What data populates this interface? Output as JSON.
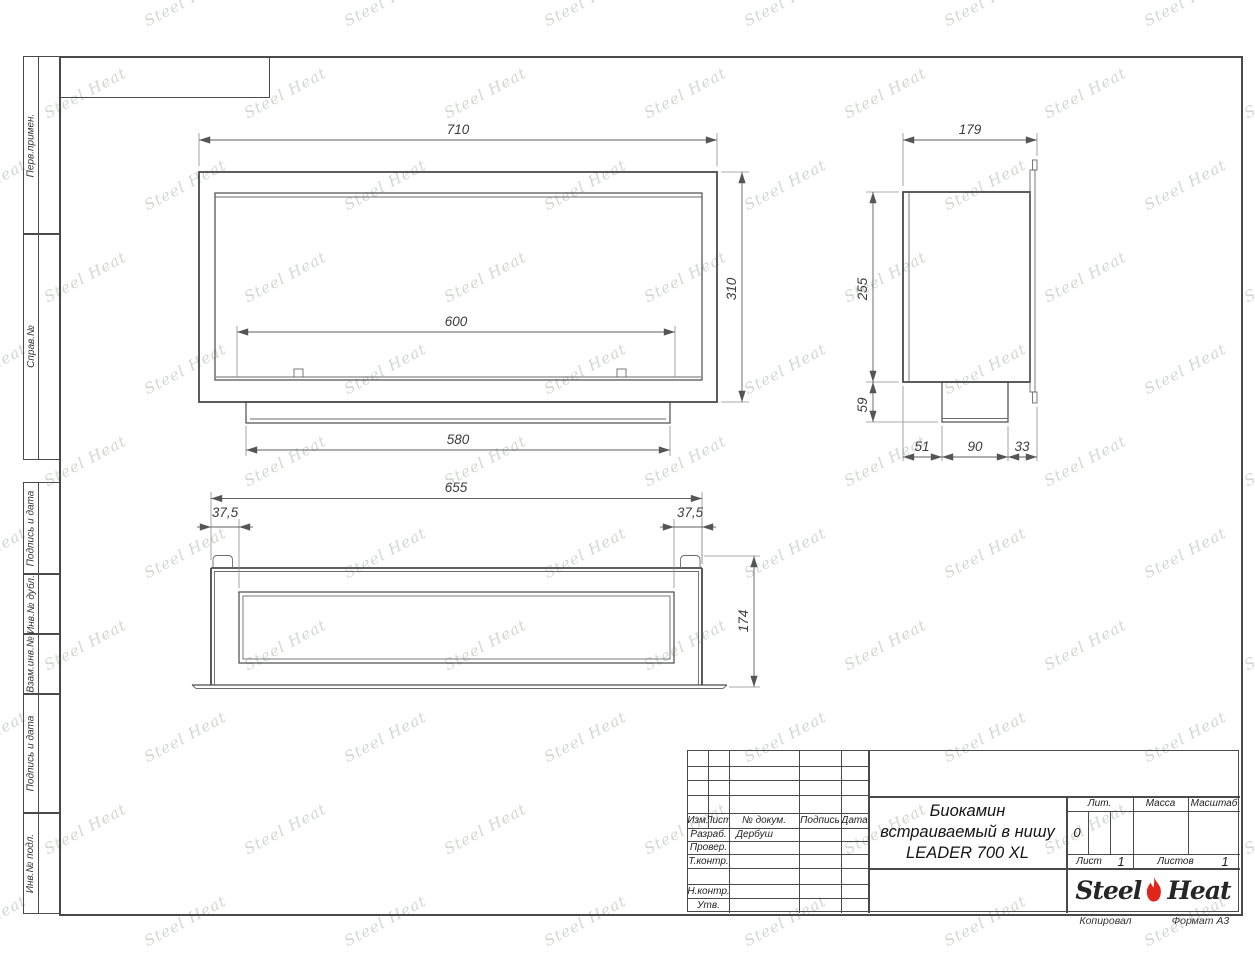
{
  "watermark": {
    "text": "Steel Heat",
    "color": "#d3d7d3"
  },
  "sidebar": {
    "cells": [
      {
        "label": "Перв.примен."
      },
      {
        "label": "Справ.№"
      },
      {
        "label": "Подпись и дата"
      },
      {
        "label": "Инв.№ дубл."
      },
      {
        "label": "Взам.инв.№"
      },
      {
        "label": "Подпись и дата"
      },
      {
        "label": "Инв.№ подл."
      }
    ]
  },
  "views": {
    "front": {
      "dim_width": "710",
      "dim_height": "310",
      "dim_opening": "600",
      "dim_base": "580"
    },
    "side": {
      "dim_depth": "179",
      "dim_height": "255",
      "dim_box": "59",
      "dim_b1": "51",
      "dim_b2": "90",
      "dim_b3": "33"
    },
    "top": {
      "dim_width": "655",
      "dim_inset_left": "37,5",
      "dim_inset_right": "37,5",
      "dim_depth": "174"
    }
  },
  "title_block": {
    "revision_header": [
      "Изм.",
      "Лист",
      "№ докум.",
      "Подпись",
      "Дата"
    ],
    "signature_rows": [
      {
        "label": "Разраб.",
        "name": "Дербуш"
      },
      {
        "label": "Провер.",
        "name": ""
      },
      {
        "label": "Т.контр.",
        "name": ""
      },
      {
        "label": "",
        "name": ""
      },
      {
        "label": "Н.контр.",
        "name": ""
      },
      {
        "label": "Утв.",
        "name": ""
      }
    ],
    "product_title": {
      "line1": "Биокамин",
      "line2": "встраиваемый в нишу",
      "line3": "LEADER 700 XL"
    },
    "lit": {
      "label": "Лит.",
      "value": "0"
    },
    "mass": {
      "label": "Масса",
      "value": ""
    },
    "scale": {
      "label": "Масштаб",
      "value": ""
    },
    "sheet": {
      "label": "Лист",
      "value": "1"
    },
    "sheets": {
      "label": "Листов",
      "value": "1"
    },
    "logo": {
      "steel": "Steel",
      "heat": "Heat",
      "flame_color": "#e2251b"
    }
  },
  "footer": {
    "copied_label": "Копировал",
    "format_label": "Формат А3"
  }
}
